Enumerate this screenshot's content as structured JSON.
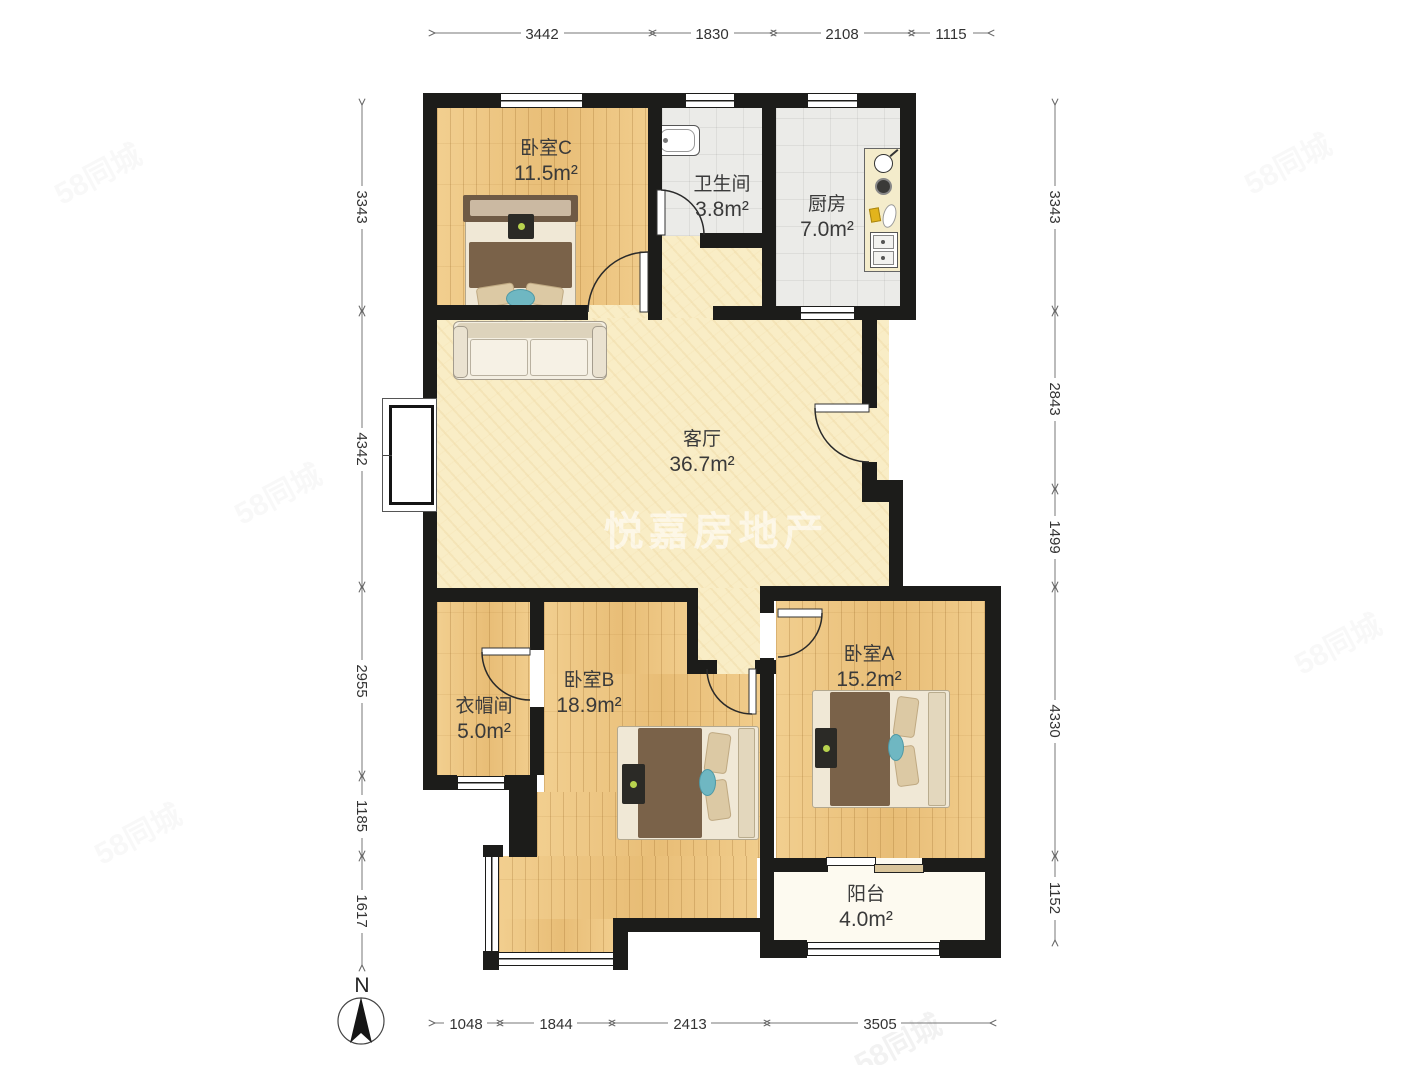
{
  "page": {
    "type": "apartment-floor-plan"
  },
  "watermark": {
    "center": "悦嘉房地产",
    "corner": "58同城"
  },
  "compass": {
    "label": "N"
  },
  "rooms": [
    {
      "name": "卧室C",
      "area": "11.5m²"
    },
    {
      "name": "卫生间",
      "area": "3.8m²"
    },
    {
      "name": "厨房",
      "area": "7.0m²"
    },
    {
      "name": "客厅",
      "area": "36.7m²"
    },
    {
      "name": "衣帽间",
      "area": "5.0m²"
    },
    {
      "name": "卧室B",
      "area": "18.9m²"
    },
    {
      "name": "卧室A",
      "area": "15.2m²"
    },
    {
      "name": "阳台",
      "area": "4.0m²"
    }
  ],
  "dimensions_mm": {
    "top": [
      "3442",
      "1830",
      "2108",
      "1115"
    ],
    "bottom": [
      "1048",
      "1844",
      "2413",
      "3505"
    ],
    "left": [
      "3343",
      "4342",
      "2955",
      "1185",
      "1617"
    ],
    "right": [
      "3343",
      "2843",
      "1499",
      "4330",
      "1152"
    ]
  },
  "colors": {
    "wall": "#1c1c1a",
    "wood_floor": "#ecc27b",
    "pale_floor": "#f9edc6",
    "tile_floor": "#ebebe8",
    "balcony_floor": "#fdfaf0",
    "accent_teal": "#6fb7c2",
    "blanket_brown": "#7a6249"
  }
}
